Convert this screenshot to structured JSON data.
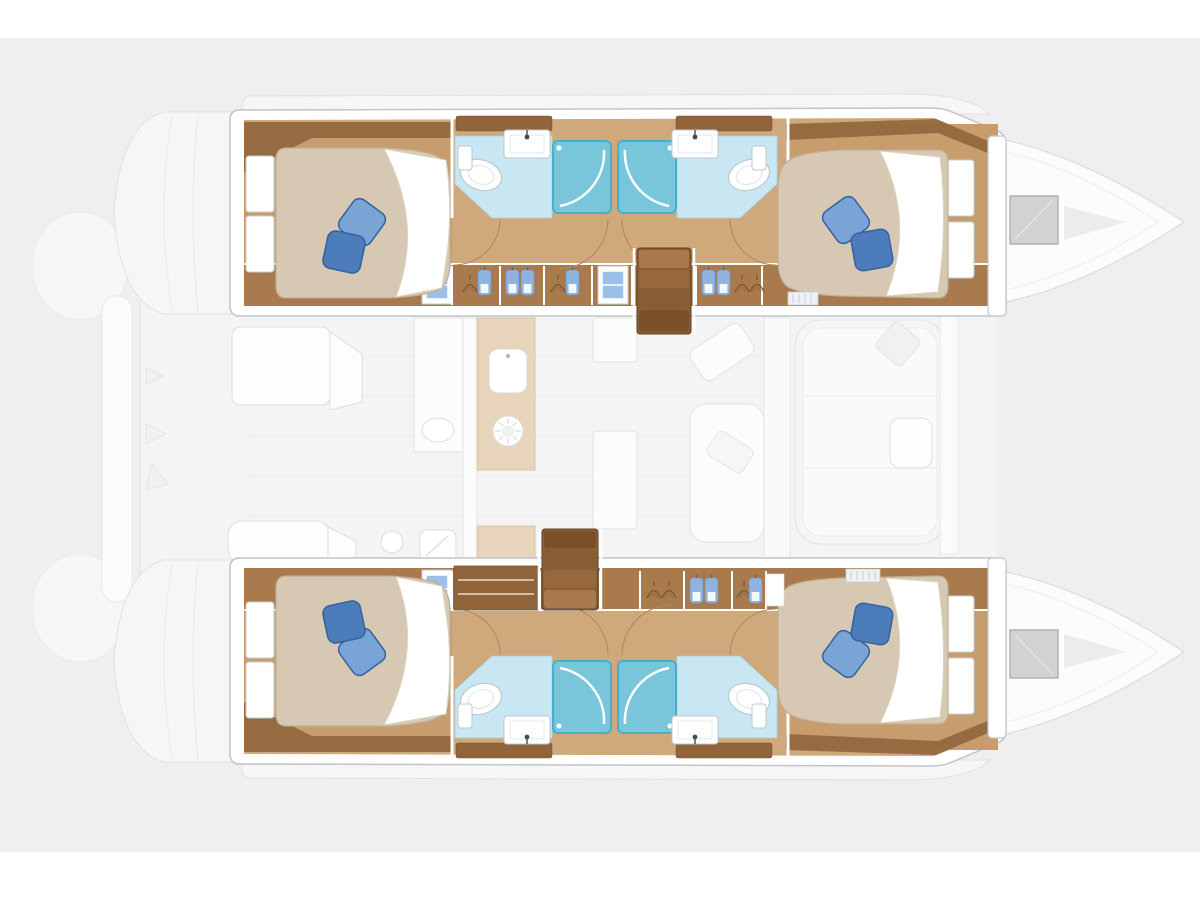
{
  "meta": {
    "type": "boat-floor-plan",
    "subject": "Sailing catamaran interior layout, top-down plan view, 4-cabin / 4-head version",
    "orientation": "bow pointing right, twin hulls top and bottom, saloon deck between",
    "visible_text": []
  },
  "palette": {
    "canvas_bg": "#efefef",
    "page_bg": "#ffffff",
    "deck_fill": "#f6f6f6",
    "deck_stroke": "#e1e1e1",
    "deck_line": "#ececec",
    "furn_fill": "#fdfdfd",
    "furn_stroke": "#dedede",
    "pale_wood": "#e8d4ba",
    "pale_wood_stroke": "#d9c4a7",
    "hull_fill": "#ffffff",
    "hull_stroke": "#bfc5cb",
    "floor_wood": "#cfa87b",
    "cabin_wood": "#c79d6d",
    "band_wood": "#a97a4d",
    "locker_wood": "#91643c",
    "stairs_wood": "#8a5f37",
    "stairs_edge": "#5e4022",
    "step1": "#a87a4e",
    "step2": "#97683c",
    "step3": "#8a5c33",
    "step4": "#7b4f2a",
    "mattress": "#d6c8b2",
    "mattress_edge": "#bfae92",
    "sheet": "#ffffff",
    "pillow_light": "#7aa4d6",
    "pillow_dark": "#4d7cba",
    "pillow_edge": "#35619f",
    "bath_floor": "#c8e7f2",
    "bath_edge": "#a4d4e6",
    "shower_fill": "#79c6db",
    "shower_edge": "#49aecb",
    "fixture_stroke": "#bcc8cf",
    "window_glass": "#9cc0e8",
    "clothes_blue": "#8fb3de",
    "hanger_brown": "#7d5a38",
    "hatch_fill": "#d2d2d2",
    "hatch_stroke": "#b2b2b2",
    "grille_fill": "#eef1f3"
  },
  "diagram": {
    "hulls": [
      {
        "name": "port hull (top)",
        "rooms": [
          "aft double cabin with wardrobe and two pillows",
          "aft head: toilet and washbasin",
          "two central shower stalls",
          "forward head: toilet and washbasin",
          "corridor with hanging lockers and hull window",
          "companionway stairs to saloon",
          "forward double cabin with wardrobe and two pillows",
          "bow locker with deck hatch"
        ]
      },
      {
        "name": "starboard hull (bottom)",
        "rooms": [
          "aft double cabin with wardrobe and two pillows",
          "aft head: toilet and washbasin",
          "two central shower stalls",
          "forward head: toilet and washbasin",
          "corridor with hanging lockers, shelf unit and hull window",
          "companionway stairs to saloon",
          "forward double cabin with wardrobe and two pillows",
          "bow locker with deck hatch"
        ]
      }
    ],
    "main_deck": [
      "aft cockpit with table and bench seating",
      "stern transom platforms with boarding steps",
      "saloon with galley: two sinks, stove, counters",
      "dinette columns",
      "forward cockpit with sunpad and table",
      "forward crossbeam",
      "twin bows with gray deck hatches"
    ],
    "fixtures": {
      "double_berths": 4,
      "pillows": 8,
      "shower_stalls": 4,
      "toilets": 4,
      "washbasins": 4,
      "companionway_stairs": 2,
      "bow_hatches": 2,
      "cabin_wardrobes": 4,
      "hull_windows": 2
    }
  }
}
